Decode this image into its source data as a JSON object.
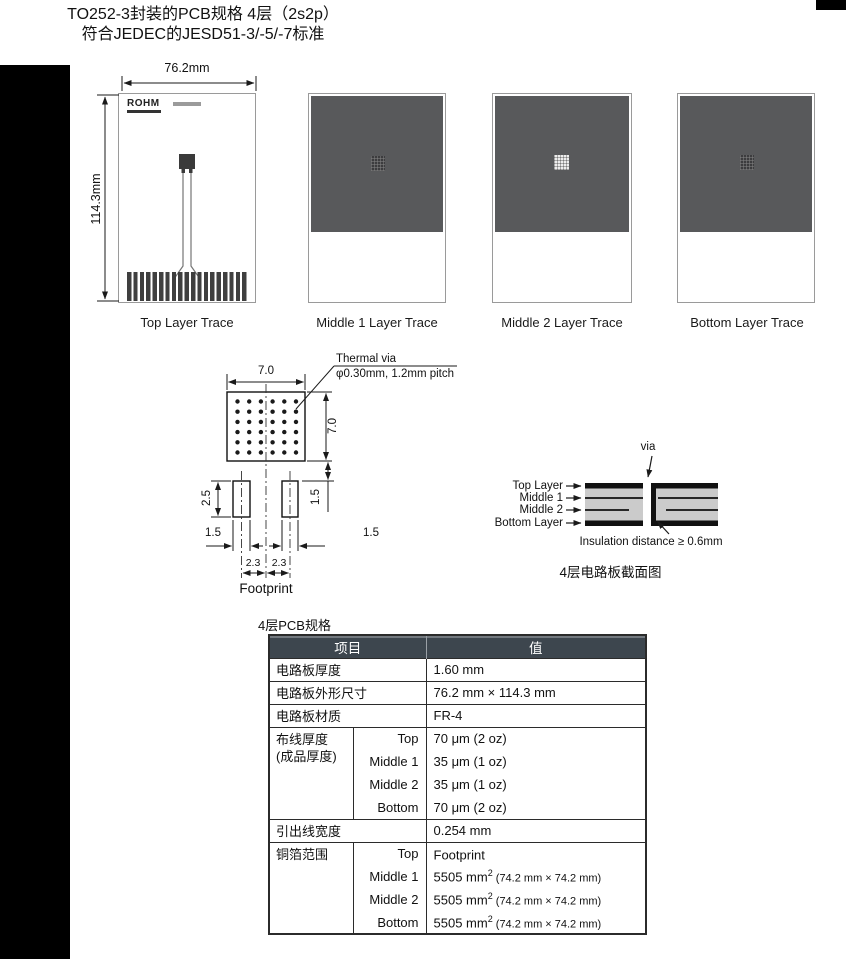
{
  "page": {
    "title_line1": "TO252-3封装的PCB规格 4层（2s2p）",
    "title_line2": "符合JEDEC的JESD51-3/-5/-7标准"
  },
  "boards": {
    "top": {
      "label": "Top Layer Trace",
      "width_dim": "76.2mm",
      "height_dim": "114.3mm",
      "logo": "ROHM"
    },
    "middle1": {
      "label": "Middle 1 Layer Trace"
    },
    "middle2": {
      "label": "Middle 2 Layer Trace"
    },
    "bottom": {
      "label": "Bottom Layer Trace"
    }
  },
  "footprint": {
    "caption": "Footprint",
    "thermal_via_label": "Thermal via",
    "thermal_via_spec": "φ0.30mm, 1.2mm pitch",
    "dim_pad_width": "7.0",
    "dim_pad_height": "7.0",
    "dim_lead_height": "2.5",
    "dim_clearance": "1.5",
    "dim_lead_width_left": "1.5",
    "dim_lead_width_right": "1.5",
    "dim_pitch_left": "2.3",
    "dim_pitch_right": "2.3"
  },
  "cross_section": {
    "via_label": "via",
    "layer_labels": [
      "Top Layer",
      "Middle 1",
      "Middle 2",
      "Bottom Layer"
    ],
    "insulation_note": "Insulation distance ≥ 0.6mm",
    "caption": "4层电路板截面图"
  },
  "spec_table": {
    "caption": "4层PCB规格",
    "header_item": "项目",
    "header_value": "值",
    "simple_rows": [
      {
        "item": "电路板厚度",
        "value": "1.60 mm"
      },
      {
        "item": "电路板外形尺寸",
        "value": "76.2 mm × 114.3 mm"
      },
      {
        "item": "电路板材质",
        "value": "FR-4"
      }
    ],
    "trace_thickness": {
      "item_line1": "布线厚度",
      "item_line2": "(成品厚度)",
      "rows": [
        {
          "layer": "Top",
          "value": "70 μm (2 oz)"
        },
        {
          "layer": "Middle 1",
          "value": "35 μm (1 oz)"
        },
        {
          "layer": "Middle 2",
          "value": "35 μm (1 oz)"
        },
        {
          "layer": "Bottom",
          "value": "70 μm (2 oz)"
        }
      ]
    },
    "lead_width_row": {
      "item": "引出线宽度",
      "value": "0.254 mm"
    },
    "copper_area": {
      "item": "铜箔范围",
      "rows": [
        {
          "layer": "Top",
          "value": "Footprint",
          "sup": "",
          "paren": ""
        },
        {
          "layer": "Middle 1",
          "value": "5505 mm",
          "sup": "2",
          "paren": " (74.2 mm × 74.2 mm)"
        },
        {
          "layer": "Middle 2",
          "value": "5505 mm",
          "sup": "2",
          "paren": " (74.2 mm × 74.2 mm)"
        },
        {
          "layer": "Bottom",
          "value": "5505 mm",
          "sup": "2",
          "paren": " (74.2 mm × 74.2 mm)"
        }
      ]
    }
  },
  "colors": {
    "copper_fill": "#58595b",
    "table_header_bg": "#3d464e",
    "black_bar": "#000000"
  }
}
